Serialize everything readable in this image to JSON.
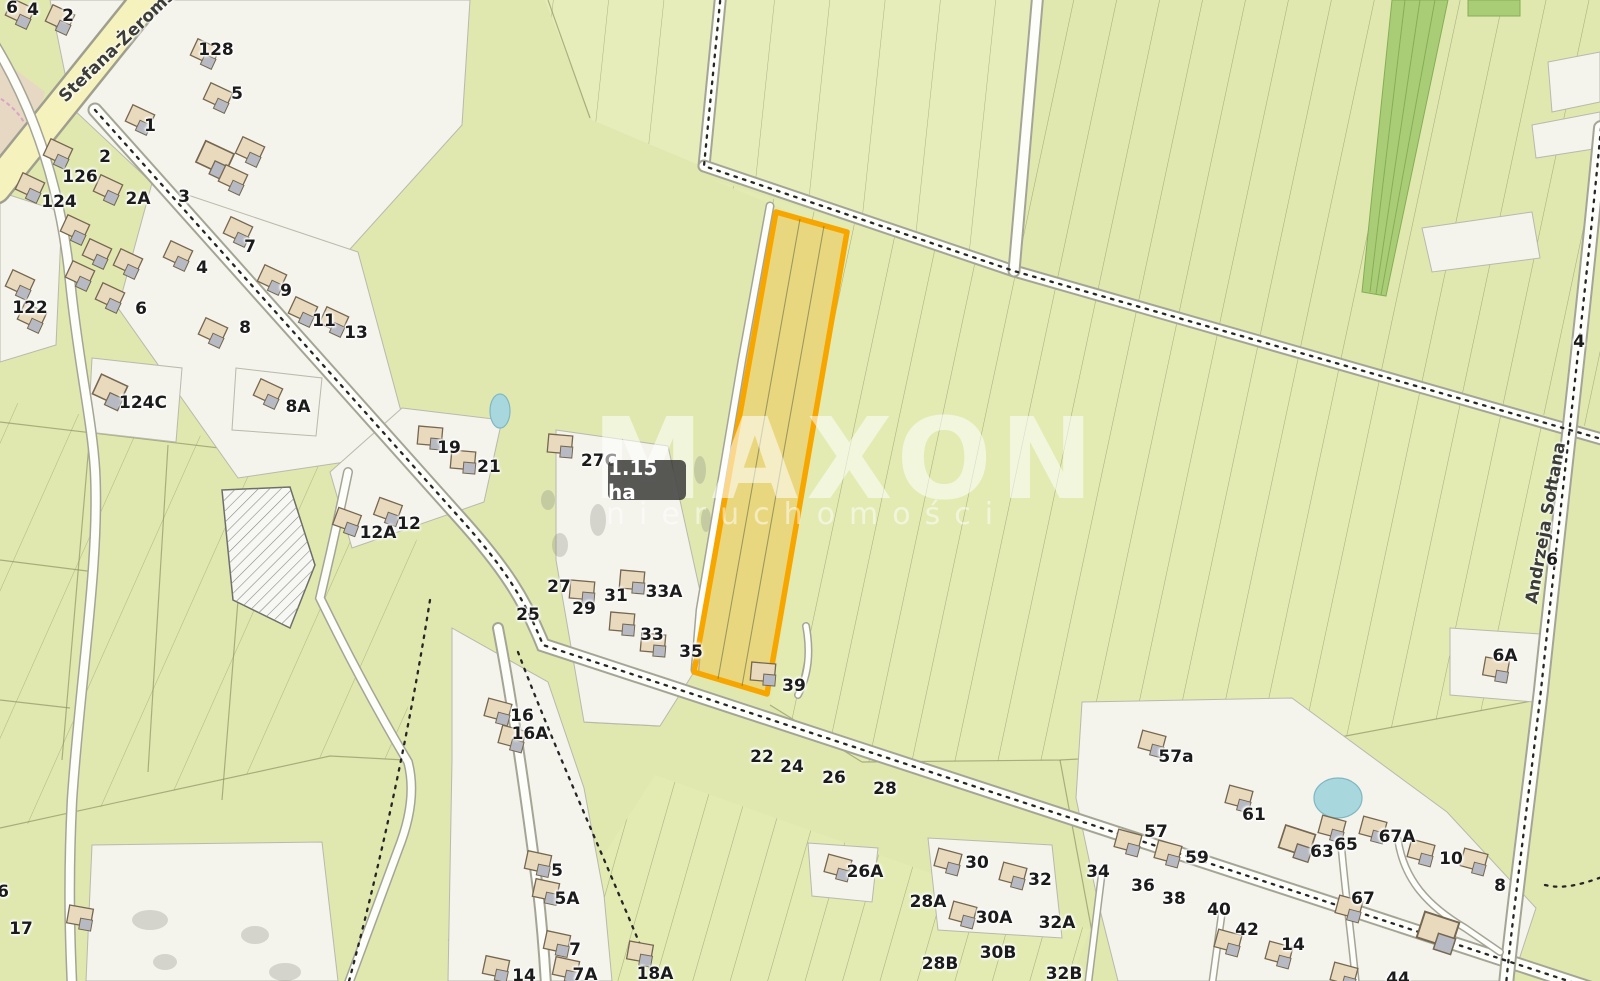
{
  "map": {
    "watermark": {
      "title": "MAXON",
      "subtitle": "nieruchomości"
    },
    "area_badge": "1.15 ha",
    "colors": {
      "field_green": "#e0e8af",
      "residential_cream": "#f4f3ec",
      "road_yellow": "#f5f2bd",
      "highlight_plot_border": "#f7a600",
      "highlight_plot_fill": "rgba(248,186,50,0.38)",
      "water": "#a8d8de",
      "forest_strip": "#a9cd77"
    },
    "streets": [
      {
        "name": "Stefana-Żeromskiego",
        "x": 136,
        "y": 28,
        "rot": -44
      },
      {
        "name": "Andrzeja Sołtana",
        "x": 1546,
        "y": 523,
        "rot": -80
      }
    ],
    "parcel_labels": [
      {
        "t": "6",
        "x": 12,
        "y": 8
      },
      {
        "t": "4",
        "x": 33,
        "y": 10
      },
      {
        "t": "2",
        "x": 68,
        "y": 16
      },
      {
        "t": "128",
        "x": 216,
        "y": 50
      },
      {
        "t": "5",
        "x": 237,
        "y": 94
      },
      {
        "t": "1",
        "x": 150,
        "y": 126
      },
      {
        "t": "2",
        "x": 105,
        "y": 157
      },
      {
        "t": "126",
        "x": 80,
        "y": 177
      },
      {
        "t": "124",
        "x": 59,
        "y": 202
      },
      {
        "t": "2A",
        "x": 138,
        "y": 199
      },
      {
        "t": "3",
        "x": 184,
        "y": 197
      },
      {
        "t": "122",
        "x": 30,
        "y": 308
      },
      {
        "t": "7",
        "x": 250,
        "y": 247
      },
      {
        "t": "4",
        "x": 202,
        "y": 268
      },
      {
        "t": "9",
        "x": 286,
        "y": 291
      },
      {
        "t": "6",
        "x": 141,
        "y": 309
      },
      {
        "t": "8",
        "x": 245,
        "y": 328
      },
      {
        "t": "11",
        "x": 324,
        "y": 321
      },
      {
        "t": "13",
        "x": 356,
        "y": 333
      },
      {
        "t": "124C",
        "x": 143,
        "y": 403
      },
      {
        "t": "8A",
        "x": 298,
        "y": 407
      },
      {
        "t": "19",
        "x": 449,
        "y": 448
      },
      {
        "t": "21",
        "x": 489,
        "y": 467
      },
      {
        "t": "27C",
        "x": 599,
        "y": 461
      },
      {
        "t": "12A",
        "x": 378,
        "y": 533
      },
      {
        "t": "12",
        "x": 409,
        "y": 524
      },
      {
        "t": "25",
        "x": 528,
        "y": 615
      },
      {
        "t": "27",
        "x": 559,
        "y": 587
      },
      {
        "t": "29",
        "x": 584,
        "y": 609
      },
      {
        "t": "31",
        "x": 616,
        "y": 596
      },
      {
        "t": "33A",
        "x": 664,
        "y": 592
      },
      {
        "t": "33",
        "x": 652,
        "y": 635
      },
      {
        "t": "35",
        "x": 691,
        "y": 652
      },
      {
        "t": "39",
        "x": 794,
        "y": 686
      },
      {
        "t": "16",
        "x": 522,
        "y": 716
      },
      {
        "t": "16A",
        "x": 530,
        "y": 734
      },
      {
        "t": "22",
        "x": 762,
        "y": 757
      },
      {
        "t": "24",
        "x": 792,
        "y": 767
      },
      {
        "t": "26",
        "x": 834,
        "y": 778
      },
      {
        "t": "28",
        "x": 885,
        "y": 789
      },
      {
        "t": "5",
        "x": 557,
        "y": 871
      },
      {
        "t": "5A",
        "x": 567,
        "y": 899
      },
      {
        "t": "7",
        "x": 575,
        "y": 950
      },
      {
        "t": "7A",
        "x": 585,
        "y": 975
      },
      {
        "t": "14",
        "x": 524,
        "y": 976
      },
      {
        "t": "18A",
        "x": 655,
        "y": 974
      },
      {
        "t": "17",
        "x": 21,
        "y": 929
      },
      {
        "t": "6",
        "x": 3,
        "y": 892
      },
      {
        "t": "26A",
        "x": 865,
        "y": 872
      },
      {
        "t": "28A",
        "x": 928,
        "y": 902
      },
      {
        "t": "28B",
        "x": 940,
        "y": 964
      },
      {
        "t": "30",
        "x": 977,
        "y": 863
      },
      {
        "t": "30A",
        "x": 994,
        "y": 918
      },
      {
        "t": "30B",
        "x": 998,
        "y": 953
      },
      {
        "t": "32",
        "x": 1040,
        "y": 880
      },
      {
        "t": "32A",
        "x": 1057,
        "y": 923
      },
      {
        "t": "32B",
        "x": 1064,
        "y": 974
      },
      {
        "t": "34",
        "x": 1098,
        "y": 872
      },
      {
        "t": "36",
        "x": 1143,
        "y": 886
      },
      {
        "t": "38",
        "x": 1174,
        "y": 899
      },
      {
        "t": "40",
        "x": 1219,
        "y": 910
      },
      {
        "t": "42",
        "x": 1247,
        "y": 930
      },
      {
        "t": "14",
        "x": 1293,
        "y": 945
      },
      {
        "t": "44",
        "x": 1398,
        "y": 979
      },
      {
        "t": "57a",
        "x": 1176,
        "y": 757
      },
      {
        "t": "57",
        "x": 1156,
        "y": 832
      },
      {
        "t": "59",
        "x": 1197,
        "y": 858
      },
      {
        "t": "61",
        "x": 1254,
        "y": 815
      },
      {
        "t": "63",
        "x": 1322,
        "y": 852
      },
      {
        "t": "65",
        "x": 1346,
        "y": 845
      },
      {
        "t": "67A",
        "x": 1397,
        "y": 837
      },
      {
        "t": "67",
        "x": 1363,
        "y": 899
      },
      {
        "t": "10",
        "x": 1451,
        "y": 859
      },
      {
        "t": "8",
        "x": 1500,
        "y": 886
      },
      {
        "t": "4",
        "x": 1579,
        "y": 342
      },
      {
        "t": "6",
        "x": 1552,
        "y": 560
      },
      {
        "t": "6A",
        "x": 1505,
        "y": 656
      }
    ],
    "buildings": [
      [
        205,
        52,
        25
      ],
      [
        218,
        96,
        25
      ],
      [
        140,
        118,
        25
      ],
      [
        58,
        152,
        25
      ],
      [
        30,
        186,
        25
      ],
      [
        108,
        188,
        25
      ],
      [
        215,
        158,
        25,
        1.3
      ],
      [
        233,
        178,
        25
      ],
      [
        75,
        228,
        25
      ],
      [
        97,
        252,
        25
      ],
      [
        128,
        262,
        25
      ],
      [
        80,
        274,
        25
      ],
      [
        238,
        230,
        25
      ],
      [
        178,
        254,
        25
      ],
      [
        272,
        278,
        25
      ],
      [
        303,
        310,
        25
      ],
      [
        334,
        320,
        25
      ],
      [
        110,
        296,
        25
      ],
      [
        213,
        331,
        25
      ],
      [
        20,
        283,
        25
      ],
      [
        32,
        316,
        25
      ],
      [
        110,
        390,
        25,
        1.2
      ],
      [
        268,
        392,
        25
      ],
      [
        80,
        916,
        10
      ],
      [
        430,
        436,
        5
      ],
      [
        463,
        460,
        5
      ],
      [
        560,
        444,
        5
      ],
      [
        347,
        520,
        20
      ],
      [
        388,
        510,
        20
      ],
      [
        582,
        590,
        5
      ],
      [
        632,
        580,
        5
      ],
      [
        622,
        622,
        5
      ],
      [
        653,
        643,
        5
      ],
      [
        763,
        672,
        5
      ],
      [
        498,
        710,
        15
      ],
      [
        512,
        737,
        15
      ],
      [
        538,
        862,
        12
      ],
      [
        546,
        890,
        12
      ],
      [
        557,
        942,
        12
      ],
      [
        566,
        968,
        12
      ],
      [
        496,
        967,
        12
      ],
      [
        640,
        952,
        10
      ],
      [
        838,
        866,
        15
      ],
      [
        948,
        860,
        15
      ],
      [
        963,
        913,
        15
      ],
      [
        1013,
        874,
        15
      ],
      [
        1152,
        742,
        15
      ],
      [
        1128,
        841,
        15
      ],
      [
        1168,
        852,
        15
      ],
      [
        1239,
        797,
        15
      ],
      [
        1297,
        841,
        18,
        1.3
      ],
      [
        1332,
        827,
        15
      ],
      [
        1373,
        828,
        15
      ],
      [
        1349,
        907,
        15
      ],
      [
        1421,
        851,
        15
      ],
      [
        1474,
        860,
        15
      ],
      [
        1438,
        930,
        18,
        1.5
      ],
      [
        1228,
        941,
        15
      ],
      [
        1279,
        953,
        15
      ],
      [
        1344,
        974,
        15
      ],
      [
        20,
        12,
        25
      ],
      [
        60,
        18,
        25
      ],
      [
        250,
        150,
        25
      ],
      [
        1496,
        668,
        10
      ]
    ]
  }
}
